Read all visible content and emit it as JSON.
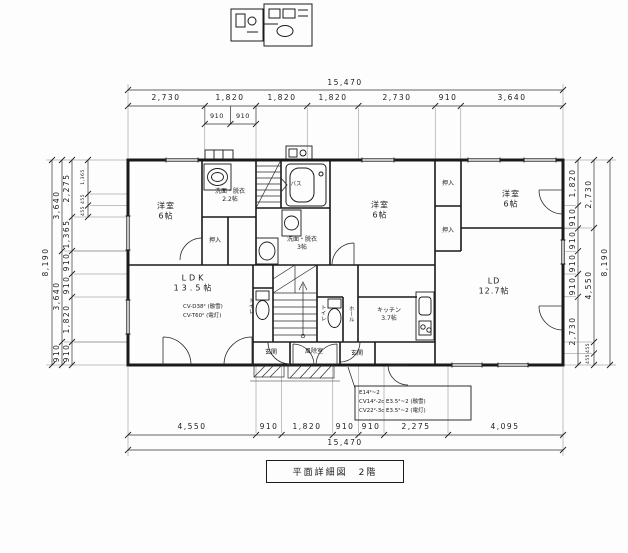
{
  "title": "平面詳細図　2階",
  "dims": {
    "top": {
      "total": "15,470",
      "chain": [
        "2,730",
        "1,820",
        "1,820",
        "1,820",
        "2,730",
        "910",
        "3,640"
      ],
      "sub": [
        "910",
        "910"
      ]
    },
    "bottom": {
      "total": "15,470",
      "chain": [
        "4,550",
        "910",
        "1,820",
        "910",
        "910",
        "2,275",
        "4,095"
      ]
    },
    "left": {
      "total": "8,190",
      "mid": [
        "3,640",
        "3,640",
        "910"
      ],
      "inner": [
        "2,275",
        "1,365",
        "910",
        "910",
        "1,820",
        "910"
      ],
      "detail": [
        "1,365",
        "455",
        "455"
      ]
    },
    "right": {
      "total": "8,190",
      "mid": [
        "2,730",
        "4,550",
        "455",
        "455"
      ],
      "inner": [
        "1,820",
        "910",
        "910",
        "910",
        "910",
        "2,730"
      ]
    }
  },
  "rooms": {
    "yoshitsu": {
      "name": "洋室",
      "size": "6帖"
    },
    "senmen_small": {
      "name": "洗面・脱衣",
      "size": "2.2帖"
    },
    "senmen_large": {
      "name": "洗面・脱衣",
      "size": "3帖"
    },
    "bath": "バス",
    "oshiire": "押入",
    "toilet": "トイレ",
    "hall": "ホール",
    "genkan": "玄関",
    "fujoshitsu": "風除室",
    "ldk": {
      "name": "LDK",
      "size": "13.5帖"
    },
    "ld": {
      "name": "LD",
      "size": "12.7帖"
    },
    "kitchen": {
      "name": "キッチン",
      "size": "3.7帖"
    }
  },
  "notes": {
    "ldk": [
      "CV-D38² (融雪)",
      "CV-T60² (電灯)"
    ],
    "electrical": [
      "E14²~2",
      "CV14²-2c E3.5²~2 (融雪)",
      "CV22²-3c E3.5²~2 (電灯)"
    ]
  }
}
